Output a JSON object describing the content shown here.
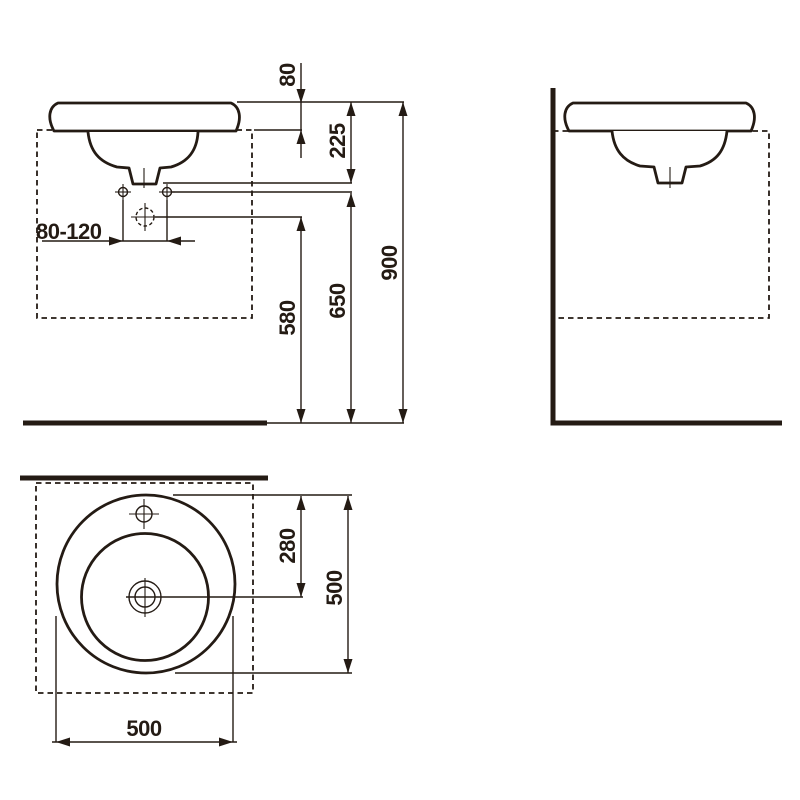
{
  "page": {
    "background": "#ffffff"
  },
  "drawing": {
    "line_color": "#241b14",
    "dims": {
      "rim_above_counter": "80",
      "rim_to_outlet": "225",
      "outlet_height": "580",
      "fixing_height": "650",
      "rim_height": "900",
      "tap_hole_spacing": "80-120",
      "front_edge_to_center": "280",
      "basin_depth": "500",
      "basin_width": "500"
    }
  }
}
